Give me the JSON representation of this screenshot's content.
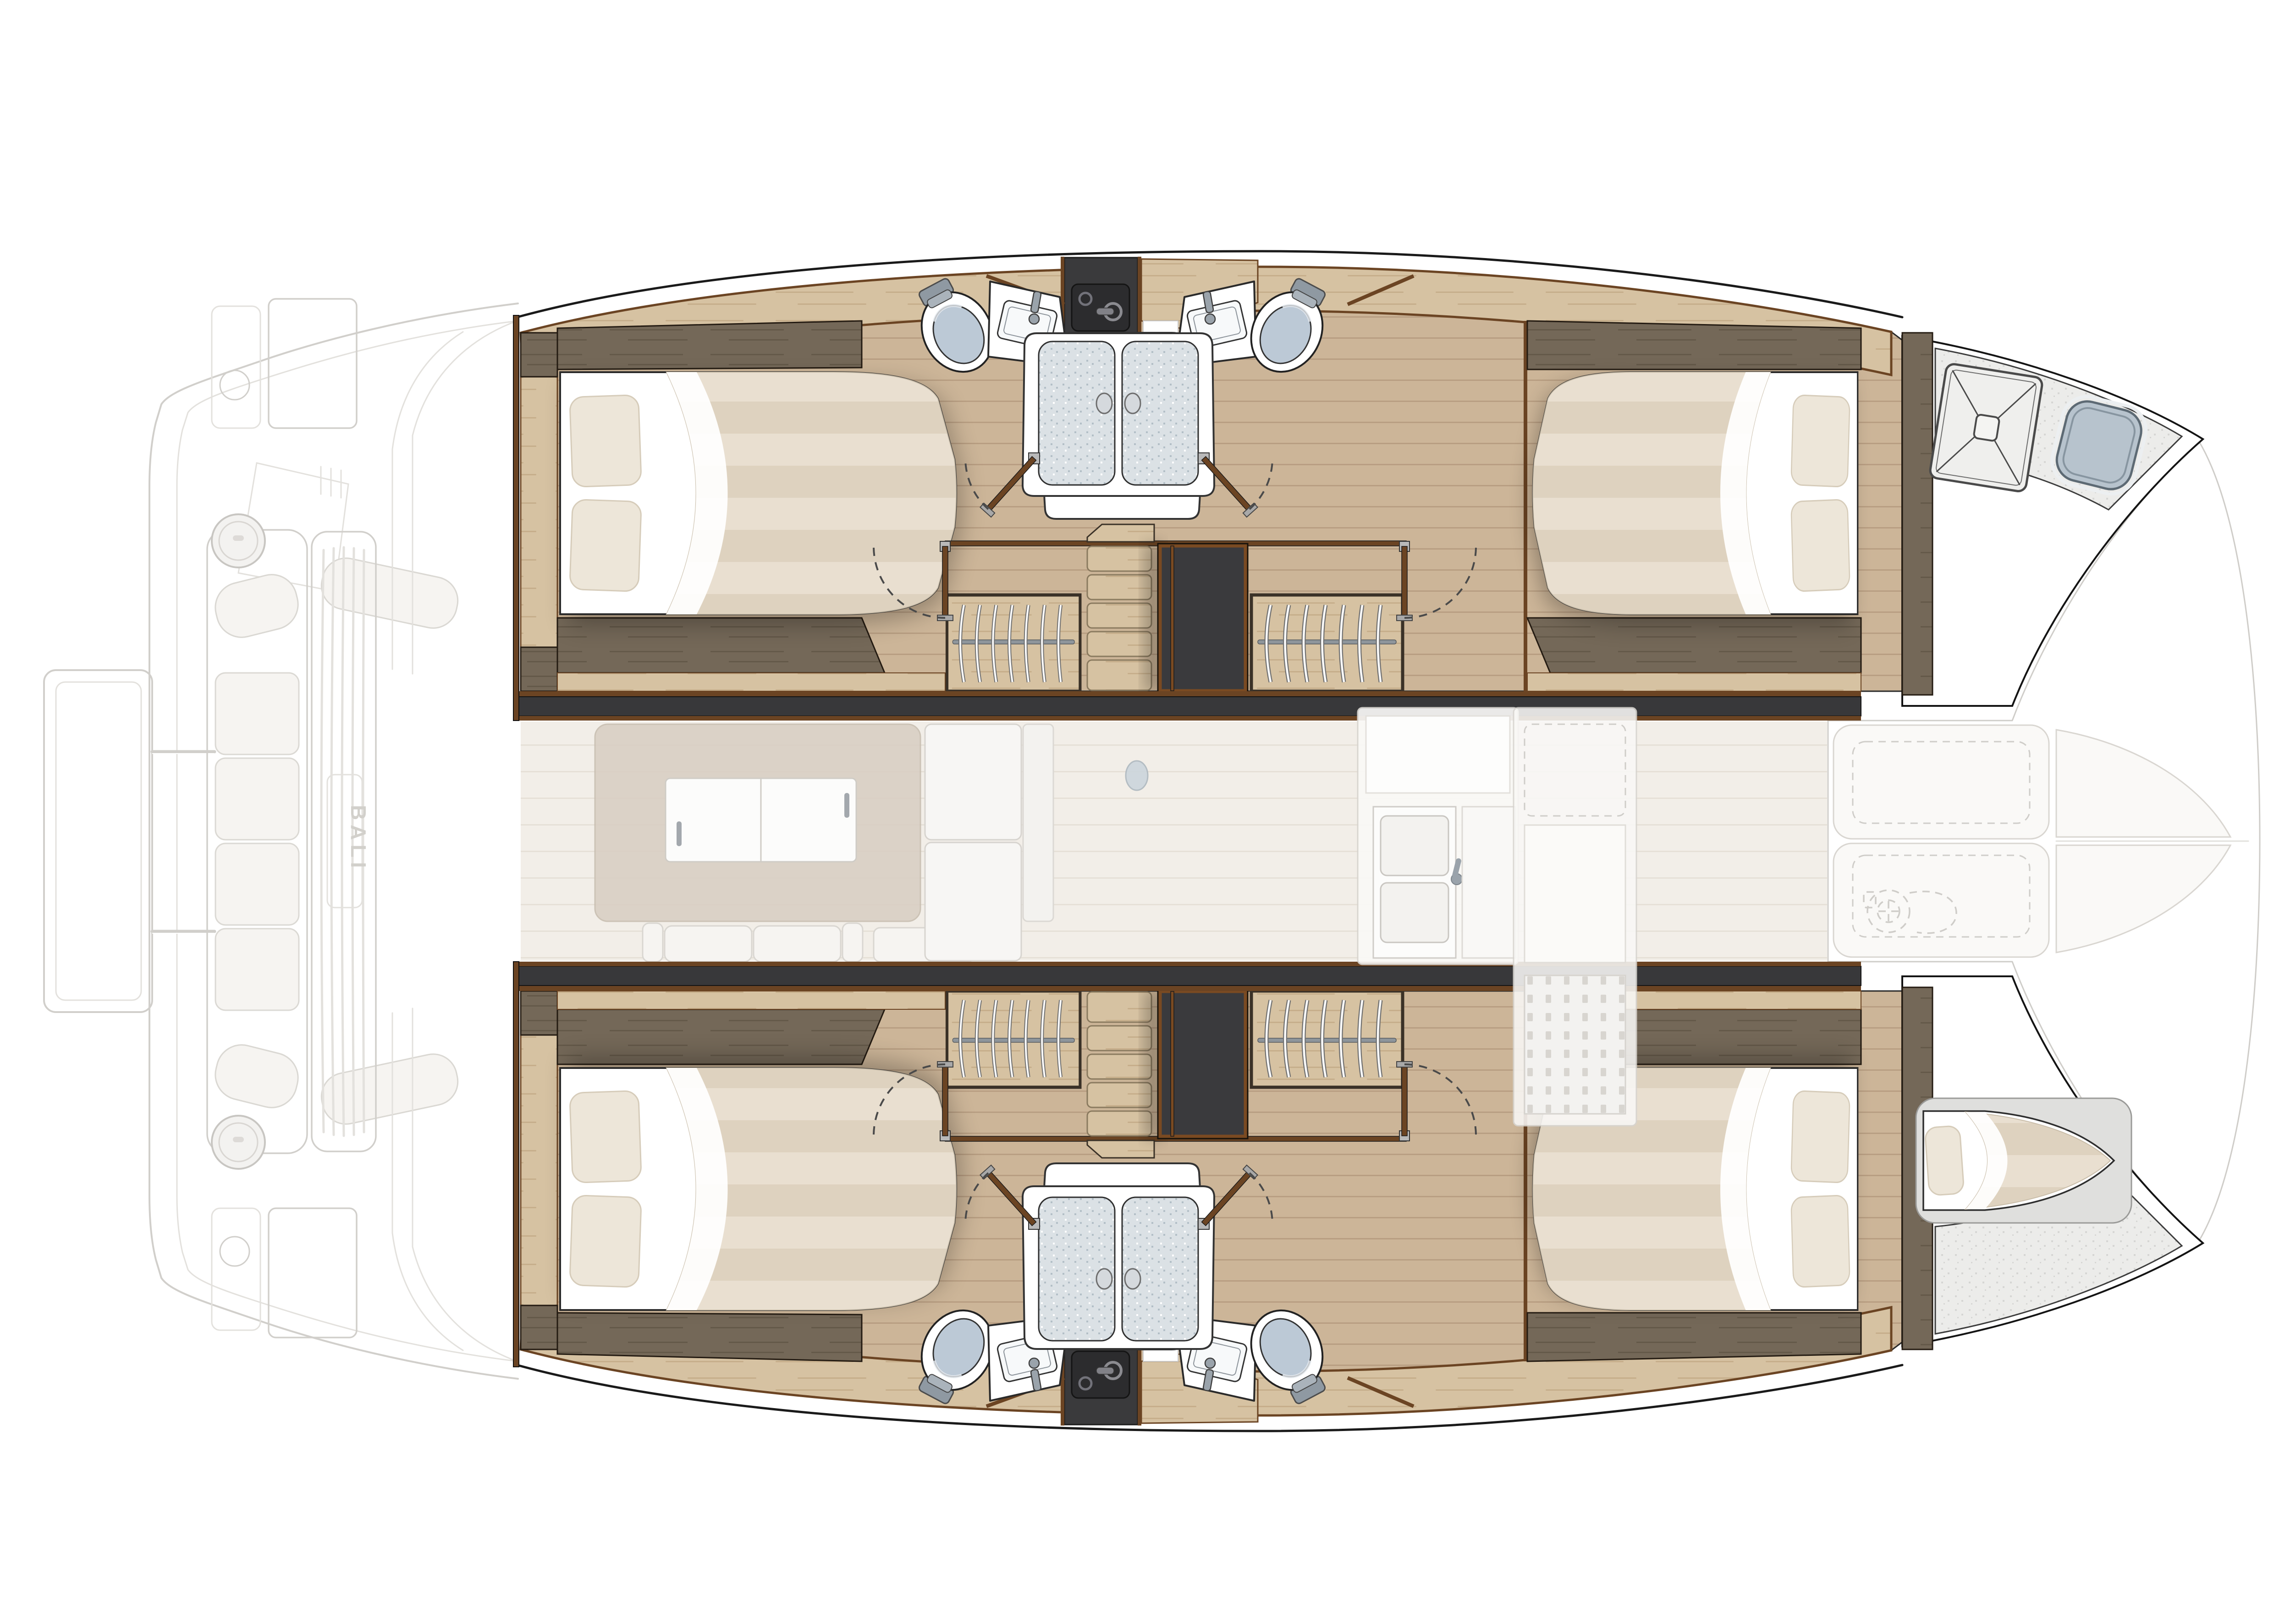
{
  "diagram": {
    "type": "boat-floor-plan",
    "subject": "catamaran interior layout, top-down view",
    "brand_mark": "BALI"
  },
  "palette": {
    "outline": "#1a1a1a",
    "trim": "#6b4423",
    "joint": "#38383a",
    "black": "#323234",
    "floor": "#ccb598",
    "floorLine": "#b89e82",
    "ash": "#d6c2a2",
    "ashLine": "#c6ae8b",
    "walnut": "#746858",
    "walnutLine": "#645949",
    "saloonFloor": "#f2eee8",
    "saloonLine": "#e6e0d7",
    "sheet": "#ffffff",
    "duvetA": "#e9dfd0",
    "duvetB": "#ded2bf",
    "pillow": "#ede6d9",
    "seatLid": "#bcc9d6",
    "glass": "#dbe1e5",
    "glassDot": "#b3bfc7",
    "speckle": "#ececea",
    "speckleDot": "#d6d6d4",
    "darkUnit": "#2c2c2e",
    "metal": "#9aa3ab",
    "hatchBlue": "#b7c3cd",
    "ghostLine": "#cfcdc9",
    "ghostLine2": "#e2e0dc",
    "ghostFill": "#f8f7f5",
    "cushion": "#f6f4f1",
    "dash": "#4a4a4a",
    "brandText": "#d0cec9"
  },
  "icons": {
    "bed-double-icon": "double berth with striped duvet, folded sheet and two pillows",
    "toilet-icon": "marine toilet, top view, blue-grey lid",
    "washbasin-icon": "angled white vanity with rectangular basin and faucet",
    "shower-doors-icon": "double sliding shower doors, speckled glass, two knobs",
    "washer-unit-icon": "dark appliance with round basin and lever handle",
    "wardrobe-hangers-icon": "wardrobe with chrome rail and curved hangers",
    "staircase-icon": "companionway steps down to hull",
    "companionway-icon": "dark stair trunk opening",
    "door-swing-icon": "hinged door leaf with dashed swing arc",
    "deck-hatch-round-icon": "round deck hatch with bolt ring",
    "hatch-cross-icon": "square forepeak hatch with diagonal cross",
    "bow-hatch-icon": "blue-grey rounded bow hatch",
    "skipper-berth-icon": "tapered single berth in bow with pillow",
    "windlass-icon": "dashed anchor windlass outline",
    "cockpit-grating-icon": "slatted cockpit grating with brand mark",
    "bench-cushions-icon": "aft bench with four cushions and bolsters",
    "galley-sink-icon": "double galley sink with faucet",
    "sliding-cabinet-icon": "white sliding-door cabinet",
    "shower-mat-icon": "dotted shower floor mat",
    "tender-platform-icon": "aft tender lifting platform"
  },
  "regions": [
    "aft-deck",
    "port-hull",
    "starboard-hull",
    "saloon",
    "foredeck-lounge",
    "port-aft-cabin",
    "port-forward-cabin",
    "starboard-aft-cabin",
    "starboard-forward-cabin",
    "port-head",
    "starboard-head",
    "port-forepeak",
    "starboard-skipper-berth"
  ]
}
